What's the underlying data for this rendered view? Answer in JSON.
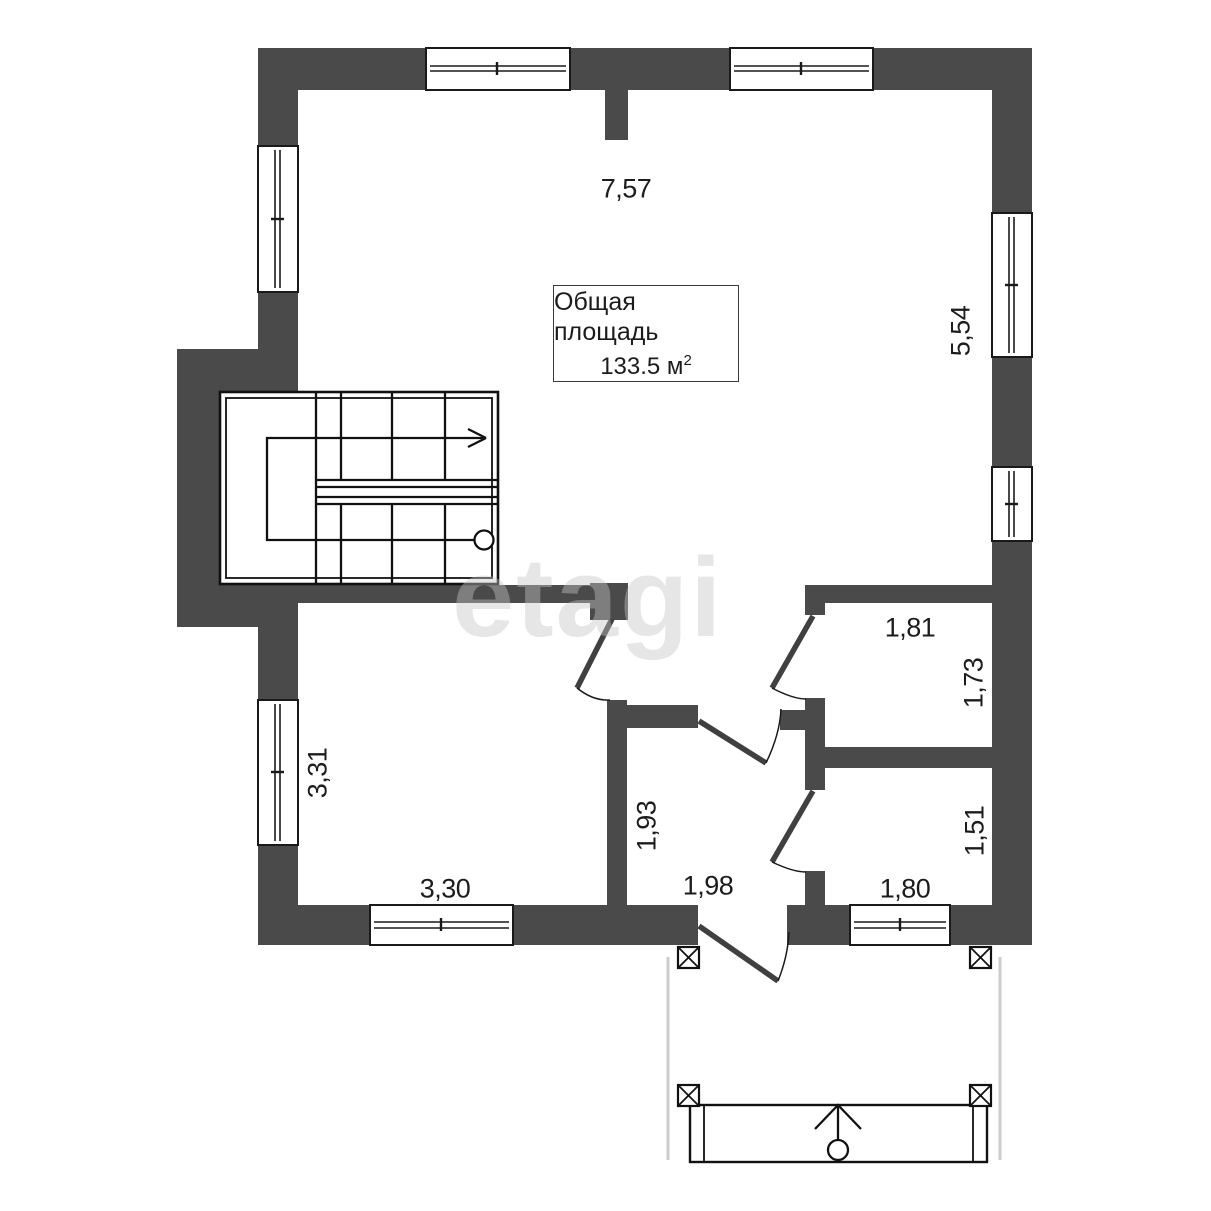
{
  "plan": {
    "watermark": "etagi",
    "area_label": {
      "title": "Общая площадь",
      "value": "133.5 м",
      "sup": "2"
    },
    "dimensions": {
      "top_width": "7,57",
      "right_height": "5,54",
      "bath_width": "1,81",
      "bath_height": "1,73",
      "room_left_height": "3,31",
      "room_left_width": "3,30",
      "hall_height": "1,93",
      "hall_width": "1,98",
      "room_right_height": "1,51",
      "room_right_width": "1,80"
    },
    "colors": {
      "wall": "#4a4a4a",
      "line": "#1a1a1a",
      "door_leaf": "#404040",
      "porch_outline": "#cccccc",
      "watermark": "#c6c6c6",
      "background": "#ffffff"
    }
  }
}
